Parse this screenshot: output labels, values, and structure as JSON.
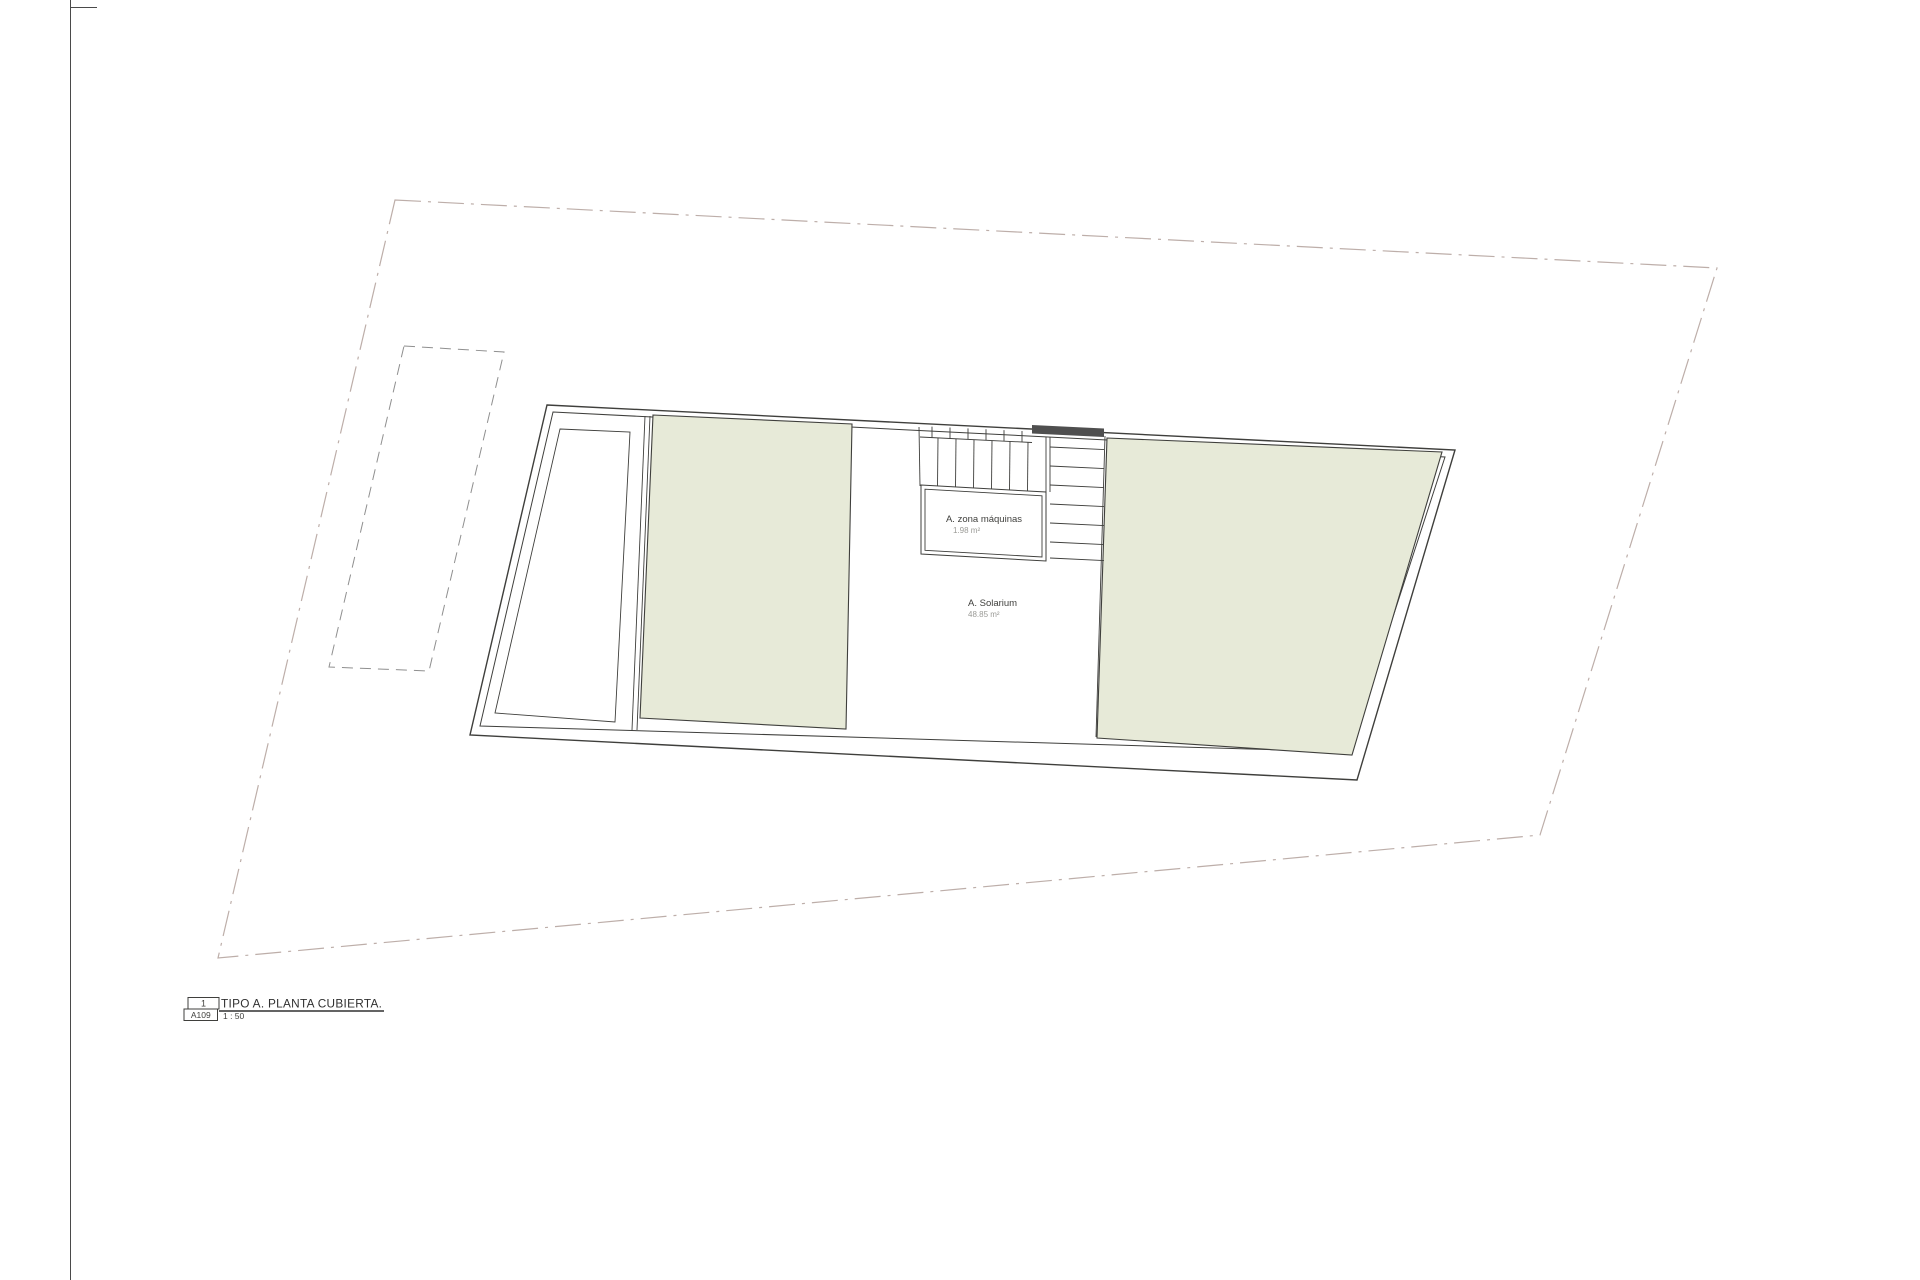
{
  "sheet": {
    "labels": {
      "machine_room_name": "A. zona máquinas",
      "machine_room_area": "1.98 m²",
      "solarium_name": "A. Solarium",
      "solarium_area": "48.85 m²"
    },
    "title_block": {
      "detail_number": "1",
      "sheet_code": "A109",
      "title": "TIPO A. PLANTA CUBIERTA.",
      "scale": "1 : 50"
    },
    "colors": {
      "roof_green": "#e7ead8",
      "parcel_line": "#b2a09a",
      "dashed_line": "#8f8f8f",
      "dark_fill": "#4f4f4f",
      "line": "#3f3f3c",
      "muted_text": "#9a9a96"
    }
  }
}
